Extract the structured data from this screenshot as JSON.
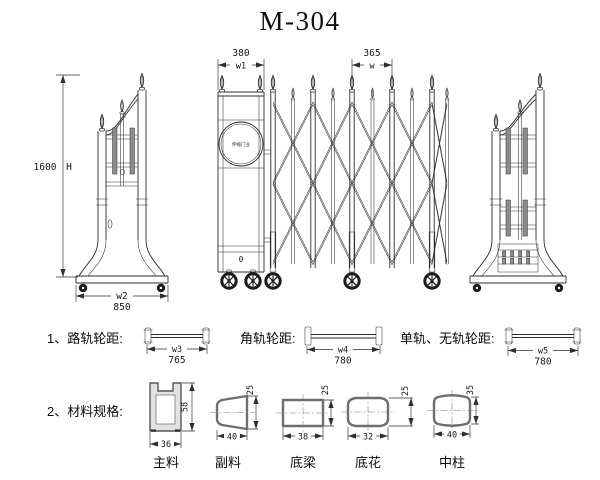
{
  "title": "M-304",
  "colors": {
    "line": "#2e2e2e",
    "background": "#ffffff"
  },
  "elevation": {
    "height_dim": {
      "value": "1600",
      "label": "H"
    },
    "head_post_dim": {
      "value": "380",
      "label": "w1"
    },
    "panel_dim": {
      "value": "365",
      "label": "w"
    },
    "base_dim": {
      "value": "850",
      "label": "w2"
    },
    "emblem_text": "伸缩门业",
    "keyhole_mark": "0"
  },
  "wheel_specs": [
    {
      "title": "1、路轨轮距:",
      "dim_label": "w3",
      "dim_value": "765"
    },
    {
      "title": "角轨轮距:",
      "dim_label": "w4",
      "dim_value": "780"
    },
    {
      "title": "单轨、无轨轮距:",
      "dim_label": "w5",
      "dim_value": "780"
    }
  ],
  "materials": {
    "title": "2、材料规格:",
    "profiles": [
      {
        "name": "主料",
        "width": "36",
        "height": "58"
      },
      {
        "name": "副料",
        "width": "40",
        "height": "25"
      },
      {
        "name": "底梁",
        "width": "38",
        "height": "25"
      },
      {
        "name": "底花",
        "width": "32",
        "height": "25"
      },
      {
        "name": "中柱",
        "width": "40",
        "height": "35"
      }
    ]
  }
}
